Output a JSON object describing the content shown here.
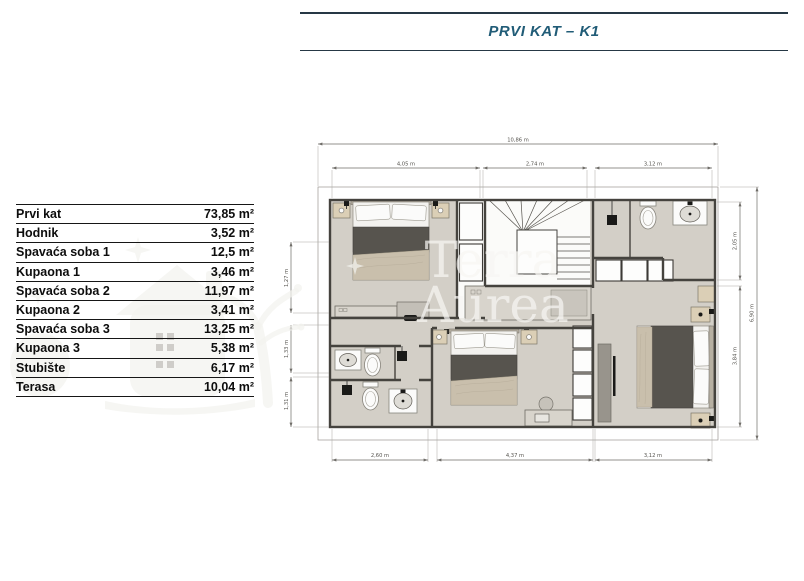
{
  "header": {
    "title": "PRVI KAT – K1"
  },
  "legend": {
    "rows": [
      {
        "name": "Prvi kat",
        "area": "73,85 m²"
      },
      {
        "name": "Hodnik",
        "area": "3,52 m²"
      },
      {
        "name": "Spavaća soba 1",
        "area": "12,5 m²"
      },
      {
        "name": "Kupaona 1",
        "area": "3,46 m²"
      },
      {
        "name": "Spavaća soba 2",
        "area": "11,97 m²"
      },
      {
        "name": "Kupaona 2",
        "area": "3,41 m²"
      },
      {
        "name": "Spavaća soba 3",
        "area": "13,25 m²"
      },
      {
        "name": "Kupaona 3",
        "area": "5,38 m²"
      },
      {
        "name": "Stubište",
        "area": "6,17 m²"
      },
      {
        "name": "Terasa",
        "area": "10,04 m²"
      }
    ]
  },
  "plan": {
    "dimensions": {
      "top_total": "10,86 m",
      "top_seg1": "4,05 m",
      "top_seg2": "2,74 m",
      "top_seg3": "3,12 m",
      "bottom_seg1": "2,60 m",
      "bottom_seg2": "4,37 m",
      "bottom_seg3": "3,12 m",
      "right_seg1": "2,05 m",
      "right_seg2": "3,84 m",
      "right_total": "6,90 m",
      "left_seg1": "1,27 m",
      "left_seg2": "1,33 m",
      "left_seg3": "1,31 m"
    },
    "watermark": {
      "line1": "Terra",
      "line2": "Aurea"
    },
    "colors": {
      "title_blue": "#215c77",
      "floor": "#d3cfc7",
      "wall": "#45433e",
      "wood": "#dbcfb6",
      "bed_dark": "#57544e"
    }
  }
}
